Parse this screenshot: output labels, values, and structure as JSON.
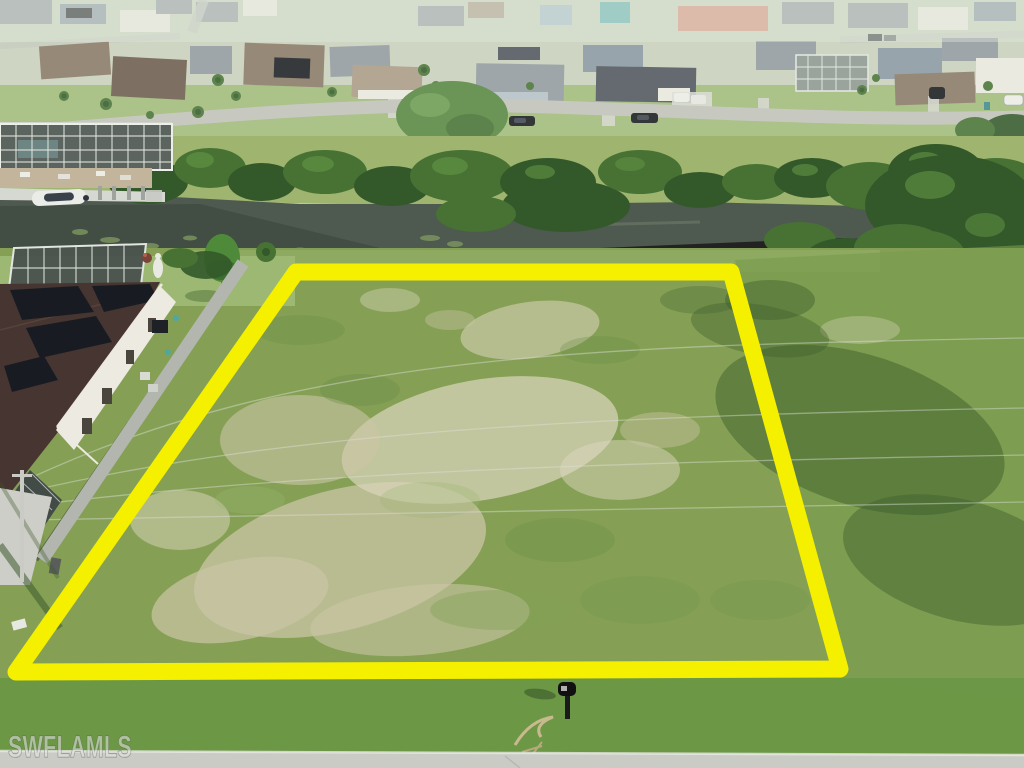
{
  "watermark": {
    "text": "SWFLAMLS"
  },
  "lot": {
    "points_str": "296,272 731,272 840,669 16,672",
    "outline_width": "17"
  },
  "colors": {
    "outline_yellow": "#F5EF00",
    "grass_field": "#85A055",
    "grass_bright": "#699745",
    "grass_far_bank": "#9FB46F",
    "grass_top_lawn": "#9DB873",
    "sand_patch": "#CBC4A5",
    "sand_light": "#DCD6BE",
    "canal_water": "#4E594F",
    "water_dark": "#3B463E",
    "veg_dark": "#33592A",
    "veg_mid": "#477234",
    "veg_bright": "#5C8C41",
    "shadow_green": "#3F5F2C",
    "road_light": "#CACBC5",
    "road_top": "#C2C4BD",
    "top_haze": "#CAD2BE",
    "roof_gray": "#939AA2",
    "roof_bluegray": "#8A98A3",
    "roof_dark": "#4E545C",
    "roof_brown": "#8A7866",
    "roof_tan": "#AB9A86",
    "roof_darkbrown": "#463530",
    "house_wall": "#EDEAE2",
    "salmon_building": "#D98F7E",
    "teal_building": "#5FB3B0",
    "solar_panel": "#181C22",
    "concrete_wall": "#B2B6AF",
    "pool_cage": "#49514D",
    "cage_frame": "#E2E6E0",
    "car_black": "#15181C",
    "watermark_fill": "rgba(230,230,228,0.55)"
  }
}
